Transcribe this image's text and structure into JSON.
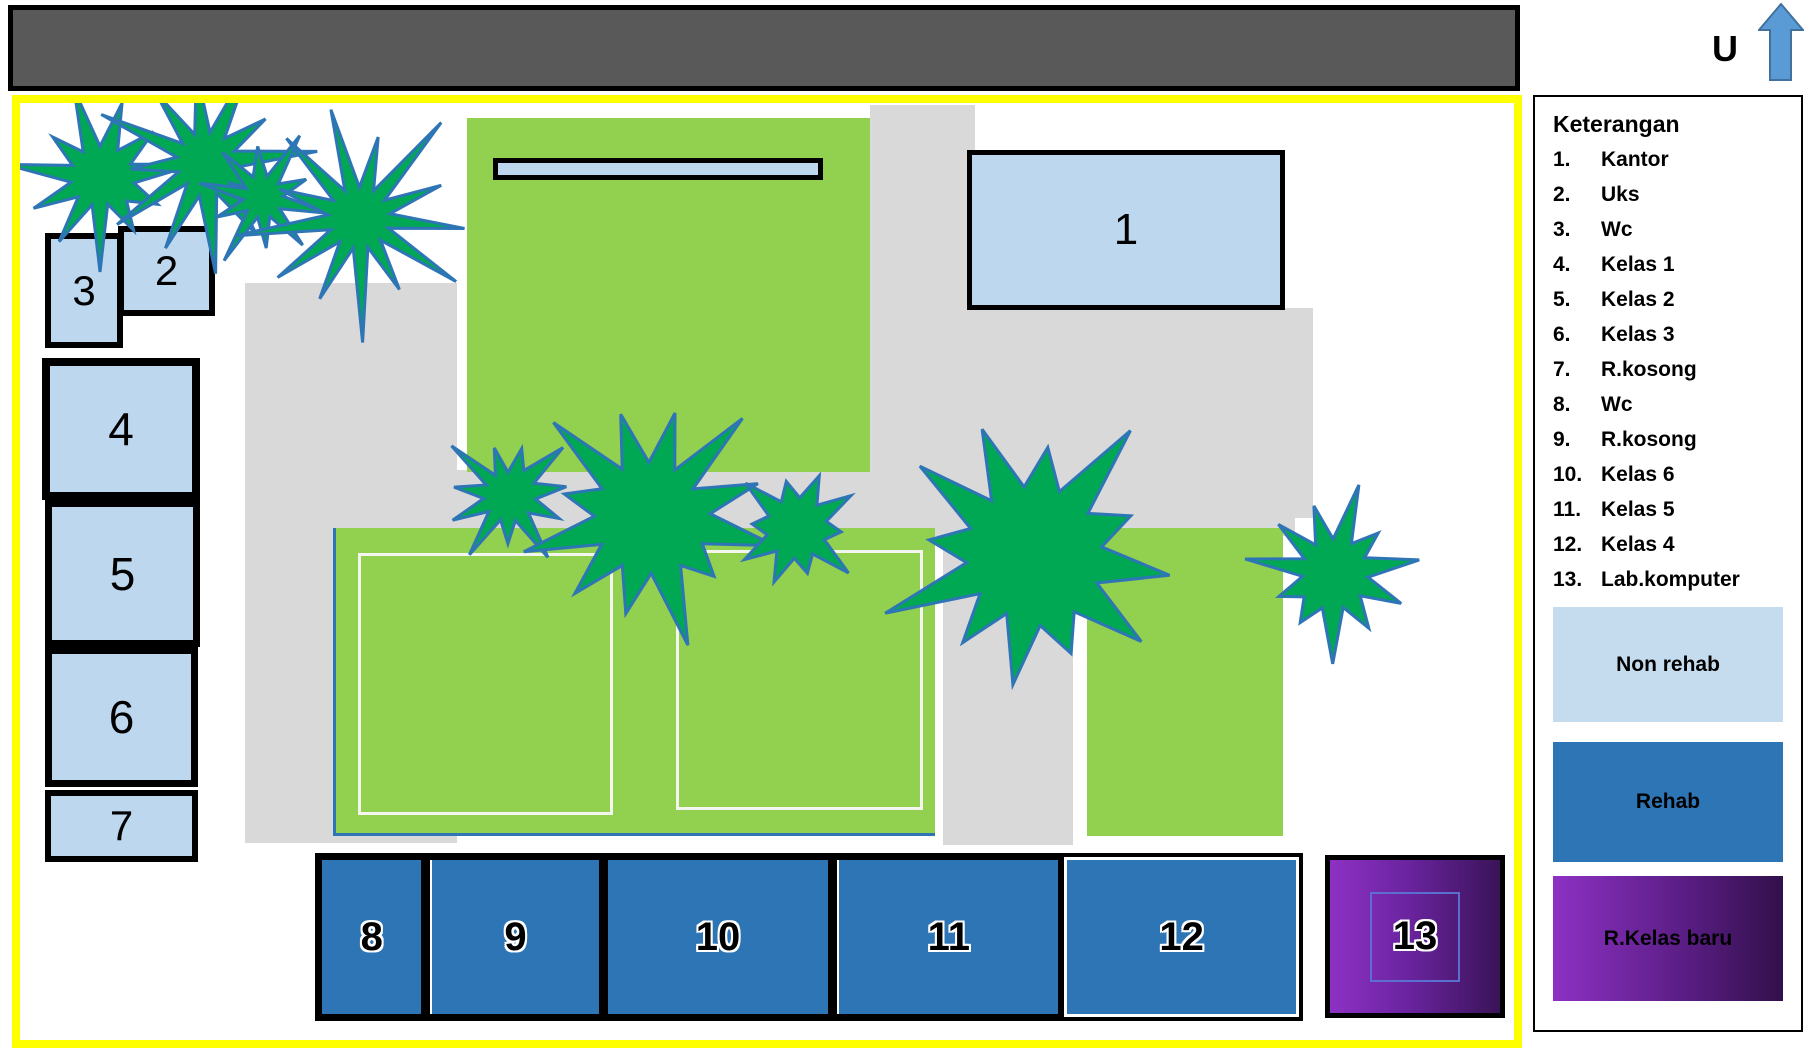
{
  "compass": {
    "label": "U"
  },
  "map": {
    "buildings": [
      {
        "num": "1",
        "name": "Kantor"
      },
      {
        "num": "2",
        "name": "Uks"
      },
      {
        "num": "3",
        "name": "Wc"
      },
      {
        "num": "4",
        "name": "Kelas 1"
      },
      {
        "num": "5",
        "name": "Kelas 2"
      },
      {
        "num": "6",
        "name": "Kelas 3"
      },
      {
        "num": "7",
        "name": "R.kosong"
      },
      {
        "num": "8",
        "name": "Wc"
      },
      {
        "num": "9",
        "name": "R.kosong"
      },
      {
        "num": "10",
        "name": "Kelas 6"
      },
      {
        "num": "11",
        "name": "Kelas 5"
      },
      {
        "num": "12",
        "name": "Kelas 4"
      },
      {
        "num": "13",
        "name": "Lab.komputer"
      }
    ]
  },
  "legend": {
    "title": "Keterangan",
    "items": [
      {
        "num": "1.",
        "label": "Kantor"
      },
      {
        "num": "2.",
        "label": "Uks"
      },
      {
        "num": "3.",
        "label": "Wc"
      },
      {
        "num": "4.",
        "label": "Kelas 1"
      },
      {
        "num": "5.",
        "label": "Kelas 2"
      },
      {
        "num": "6.",
        "label": "Kelas 3"
      },
      {
        "num": "7.",
        "label": "R.kosong"
      },
      {
        "num": "8.",
        "label": "Wc"
      },
      {
        "num": "9.",
        "label": "R.kosong"
      },
      {
        "num": "10.",
        "label": "Kelas 6"
      },
      {
        "num": "11.",
        "label": "Kelas 5"
      },
      {
        "num": "12.",
        "label": "Kelas 4"
      },
      {
        "num": "13.",
        "label": "Lab.komputer"
      }
    ],
    "swatches": [
      {
        "label": "Non rehab",
        "color": "#c5dbee"
      },
      {
        "label": "Rehab",
        "color": "#2e75b6"
      },
      {
        "label": "R.Kelas baru",
        "gradient_start": "#8d31c4",
        "gradient_end": "#32104b"
      }
    ]
  },
  "colors": {
    "road_gray": "#595959",
    "map_border_yellow": "#ffff00",
    "path_gray": "#d9d9d9",
    "field_green": "#92d050",
    "tree_green": "#00a854",
    "tree_outline_blue": "#2e75b6",
    "non_rehab_blue": "#bdd7ee",
    "rehab_blue": "#2e75b6",
    "north_arrow_blue": "#5b9bd5"
  }
}
